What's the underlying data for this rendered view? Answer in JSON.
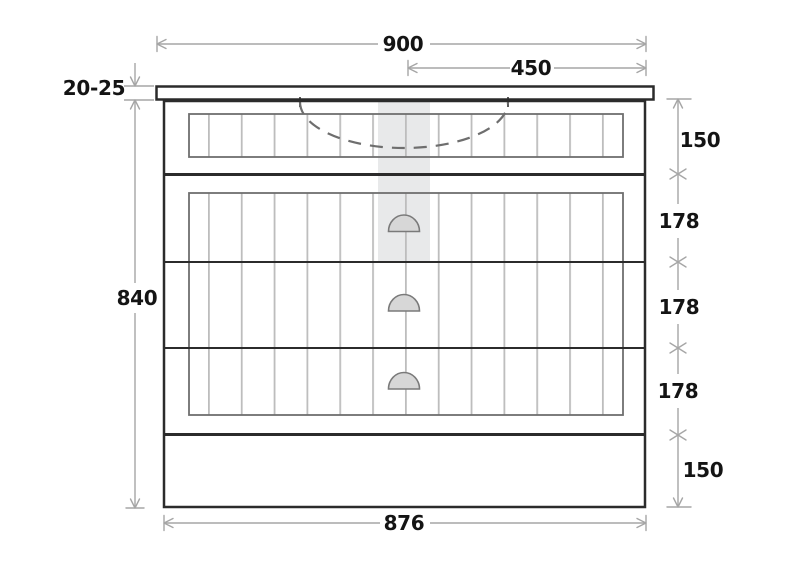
{
  "drawing": {
    "kind": "front-elevation-technical-drawing"
  },
  "colors": {
    "outline": "#2b2b2b",
    "dimension_line": "#a6a6a6",
    "label_text": "#141414",
    "highlight_band": "#e8e9ea",
    "slat_line": "#bdbdbd",
    "handle_fill": "#d7d7d7",
    "handle_stroke": "#7a7a7a",
    "basin_dash": "#6e6e6e"
  },
  "dimensions": {
    "overall_width": "900",
    "basin_offset": "450",
    "countertop_thickness": "20-25",
    "overall_height": "840",
    "top_rail_height": "150",
    "drawer_1_height": "178",
    "drawer_2_height": "178",
    "drawer_3_height": "178",
    "plinth_height": "150",
    "cabinet_base_width": "876"
  }
}
